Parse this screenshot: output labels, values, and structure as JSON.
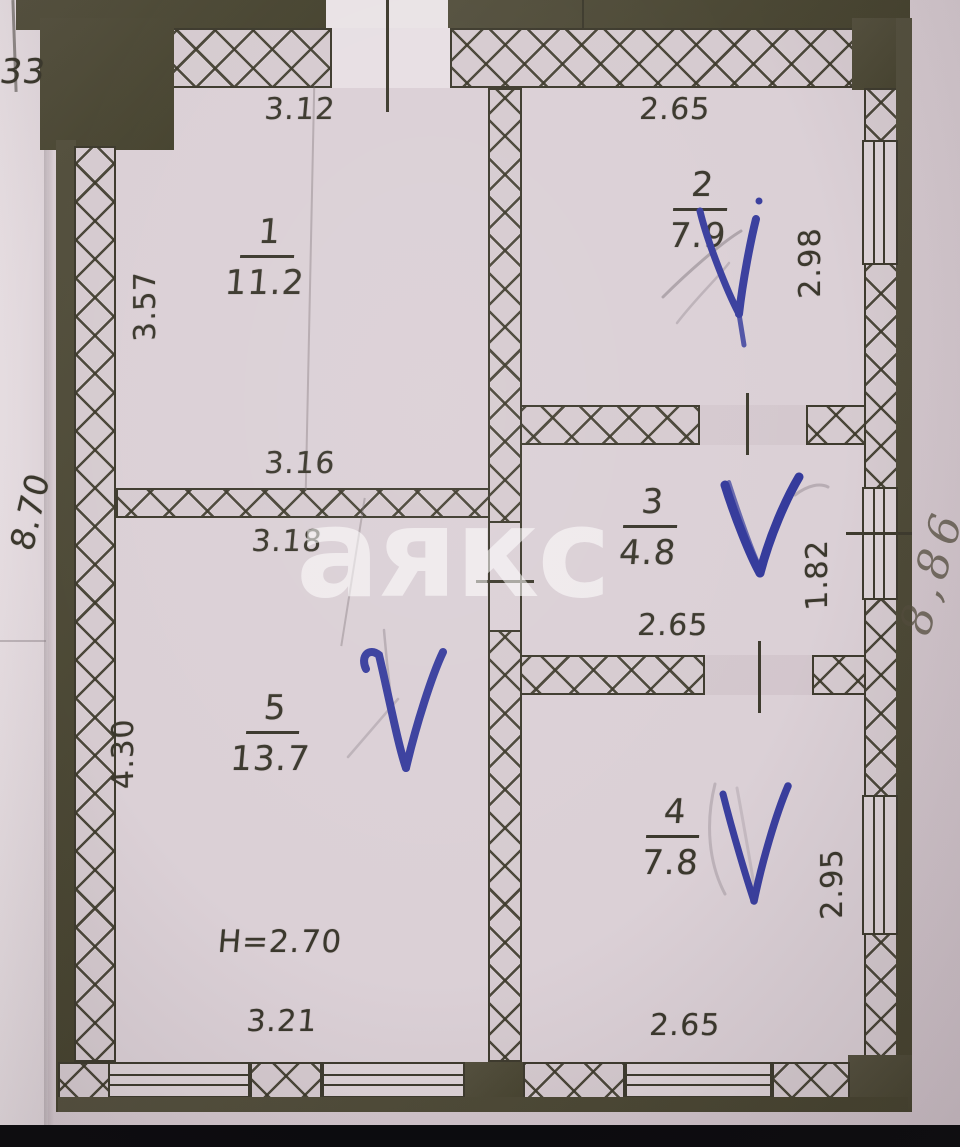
{
  "watermark_text": "аякс",
  "margin_notes": {
    "top_left": "33",
    "left_side": "8.70",
    "right_side": "8,86"
  },
  "plan": {
    "type": "apartment-floor-plan",
    "height_note": "H=2.70",
    "check_color": "#3a3f9e",
    "rooms": [
      {
        "number": "1",
        "area": "11.2",
        "dim_top": "3.12",
        "dim_left": "3.57",
        "dim_bottom": "3.16",
        "checked": false
      },
      {
        "number": "2",
        "area": "7.9",
        "dim_top": "2.65",
        "dim_right": "2.98",
        "checked": true
      },
      {
        "number": "3",
        "area": "4.8",
        "dim_bottom": "2.65",
        "dim_right": "1.82",
        "checked": true
      },
      {
        "number": "4",
        "area": "7.8",
        "dim_bottom": "2.65",
        "dim_right": "2.95",
        "checked": true
      },
      {
        "number": "5",
        "area": "13.7",
        "dim_top": "3.18",
        "dim_left": "4.30",
        "dim_bottom": "3.21",
        "checked": true
      }
    ]
  }
}
